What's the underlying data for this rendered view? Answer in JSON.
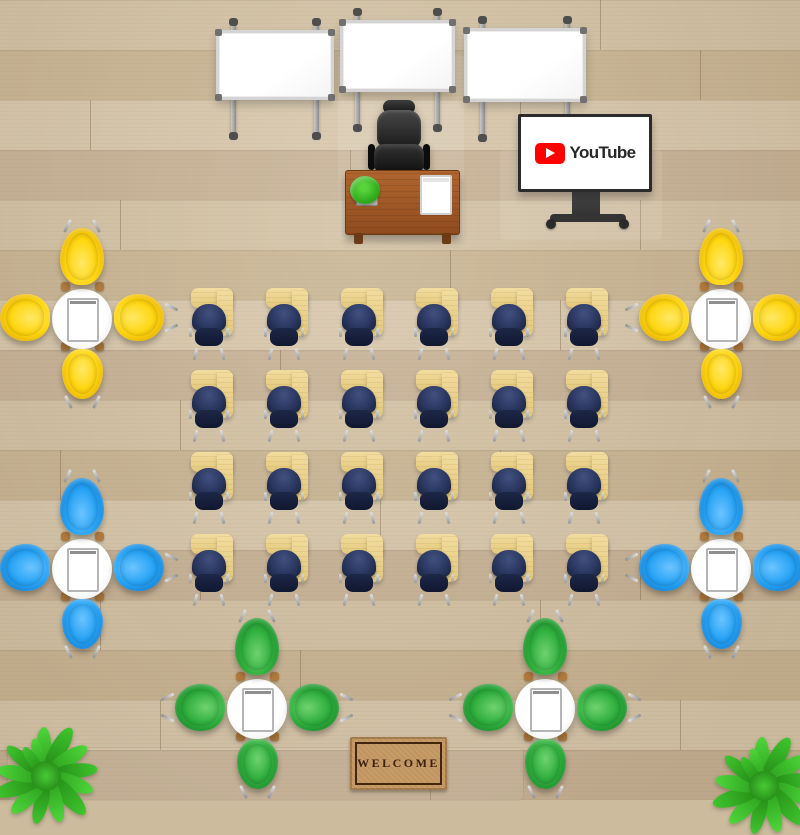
{
  "scene": {
    "description": "Top-down virtual classroom with three whiteboards, teacher desk and chair, YouTube display on rolling stand, a 4x6 grid of student tablet-arm desks with navy chairs, six round group tables with colored shell chairs, two corner plants and a welcome doormat"
  },
  "display": {
    "label": "YouTube",
    "logo_red": "#ff0000",
    "label_color": "#282828"
  },
  "doormat": {
    "text": "WELCOME",
    "mat_color": "#c89c66",
    "frame_color": "#42260f",
    "text_color": "#3a2110"
  },
  "floor": {
    "base": "#cdbb9d"
  },
  "teacher_area": {
    "whiteboard_count": 3,
    "desk_items": [
      "plant",
      "notebook"
    ]
  },
  "desk_grid": {
    "rows": 4,
    "cols": 6,
    "origin_x": 191,
    "origin_y": 288,
    "spacing_x": 75,
    "spacing_y": 82,
    "desk_top_color": "#eed08c",
    "chair_color": "#2a3760"
  },
  "whiteboards": [
    {
      "id": "whiteboard-left",
      "x": 216,
      "y": 30,
      "w": 118,
      "h": 70
    },
    {
      "id": "whiteboard-center",
      "x": 340,
      "y": 20,
      "w": 115,
      "h": 72
    },
    {
      "id": "whiteboard-right",
      "x": 464,
      "y": 28,
      "w": 122,
      "h": 74
    }
  ],
  "table_groups": [
    {
      "id": "table-yellow-left",
      "cx": 82,
      "cy": 317,
      "chair_main": "#ffd60f",
      "chair_light": "#ffe866",
      "chair_dark": "#d99e00"
    },
    {
      "id": "table-yellow-right",
      "cx": 721,
      "cy": 317,
      "chair_main": "#ffd60f",
      "chair_light": "#ffe866",
      "chair_dark": "#d99e00"
    },
    {
      "id": "table-blue-left",
      "cx": 82,
      "cy": 567,
      "chair_main": "#27a3f5",
      "chair_light": "#6cc4ff",
      "chair_dark": "#0c6fc0"
    },
    {
      "id": "table-blue-right",
      "cx": 721,
      "cy": 567,
      "chair_main": "#27a3f5",
      "chair_light": "#6cc4ff",
      "chair_dark": "#0c6fc0"
    },
    {
      "id": "table-green-left",
      "cx": 257,
      "cy": 707,
      "chair_main": "#2fae3d",
      "chair_light": "#6fd36f",
      "chair_dark": "#147a25"
    },
    {
      "id": "table-green-right",
      "cx": 545,
      "cy": 707,
      "chair_main": "#2fae3d",
      "chair_light": "#6fd36f",
      "chair_dark": "#147a25"
    }
  ],
  "plants": [
    {
      "id": "plant-bottom-left",
      "cx": 46,
      "cy": 776
    },
    {
      "id": "plant-bottom-right",
      "cx": 764,
      "cy": 786
    }
  ]
}
